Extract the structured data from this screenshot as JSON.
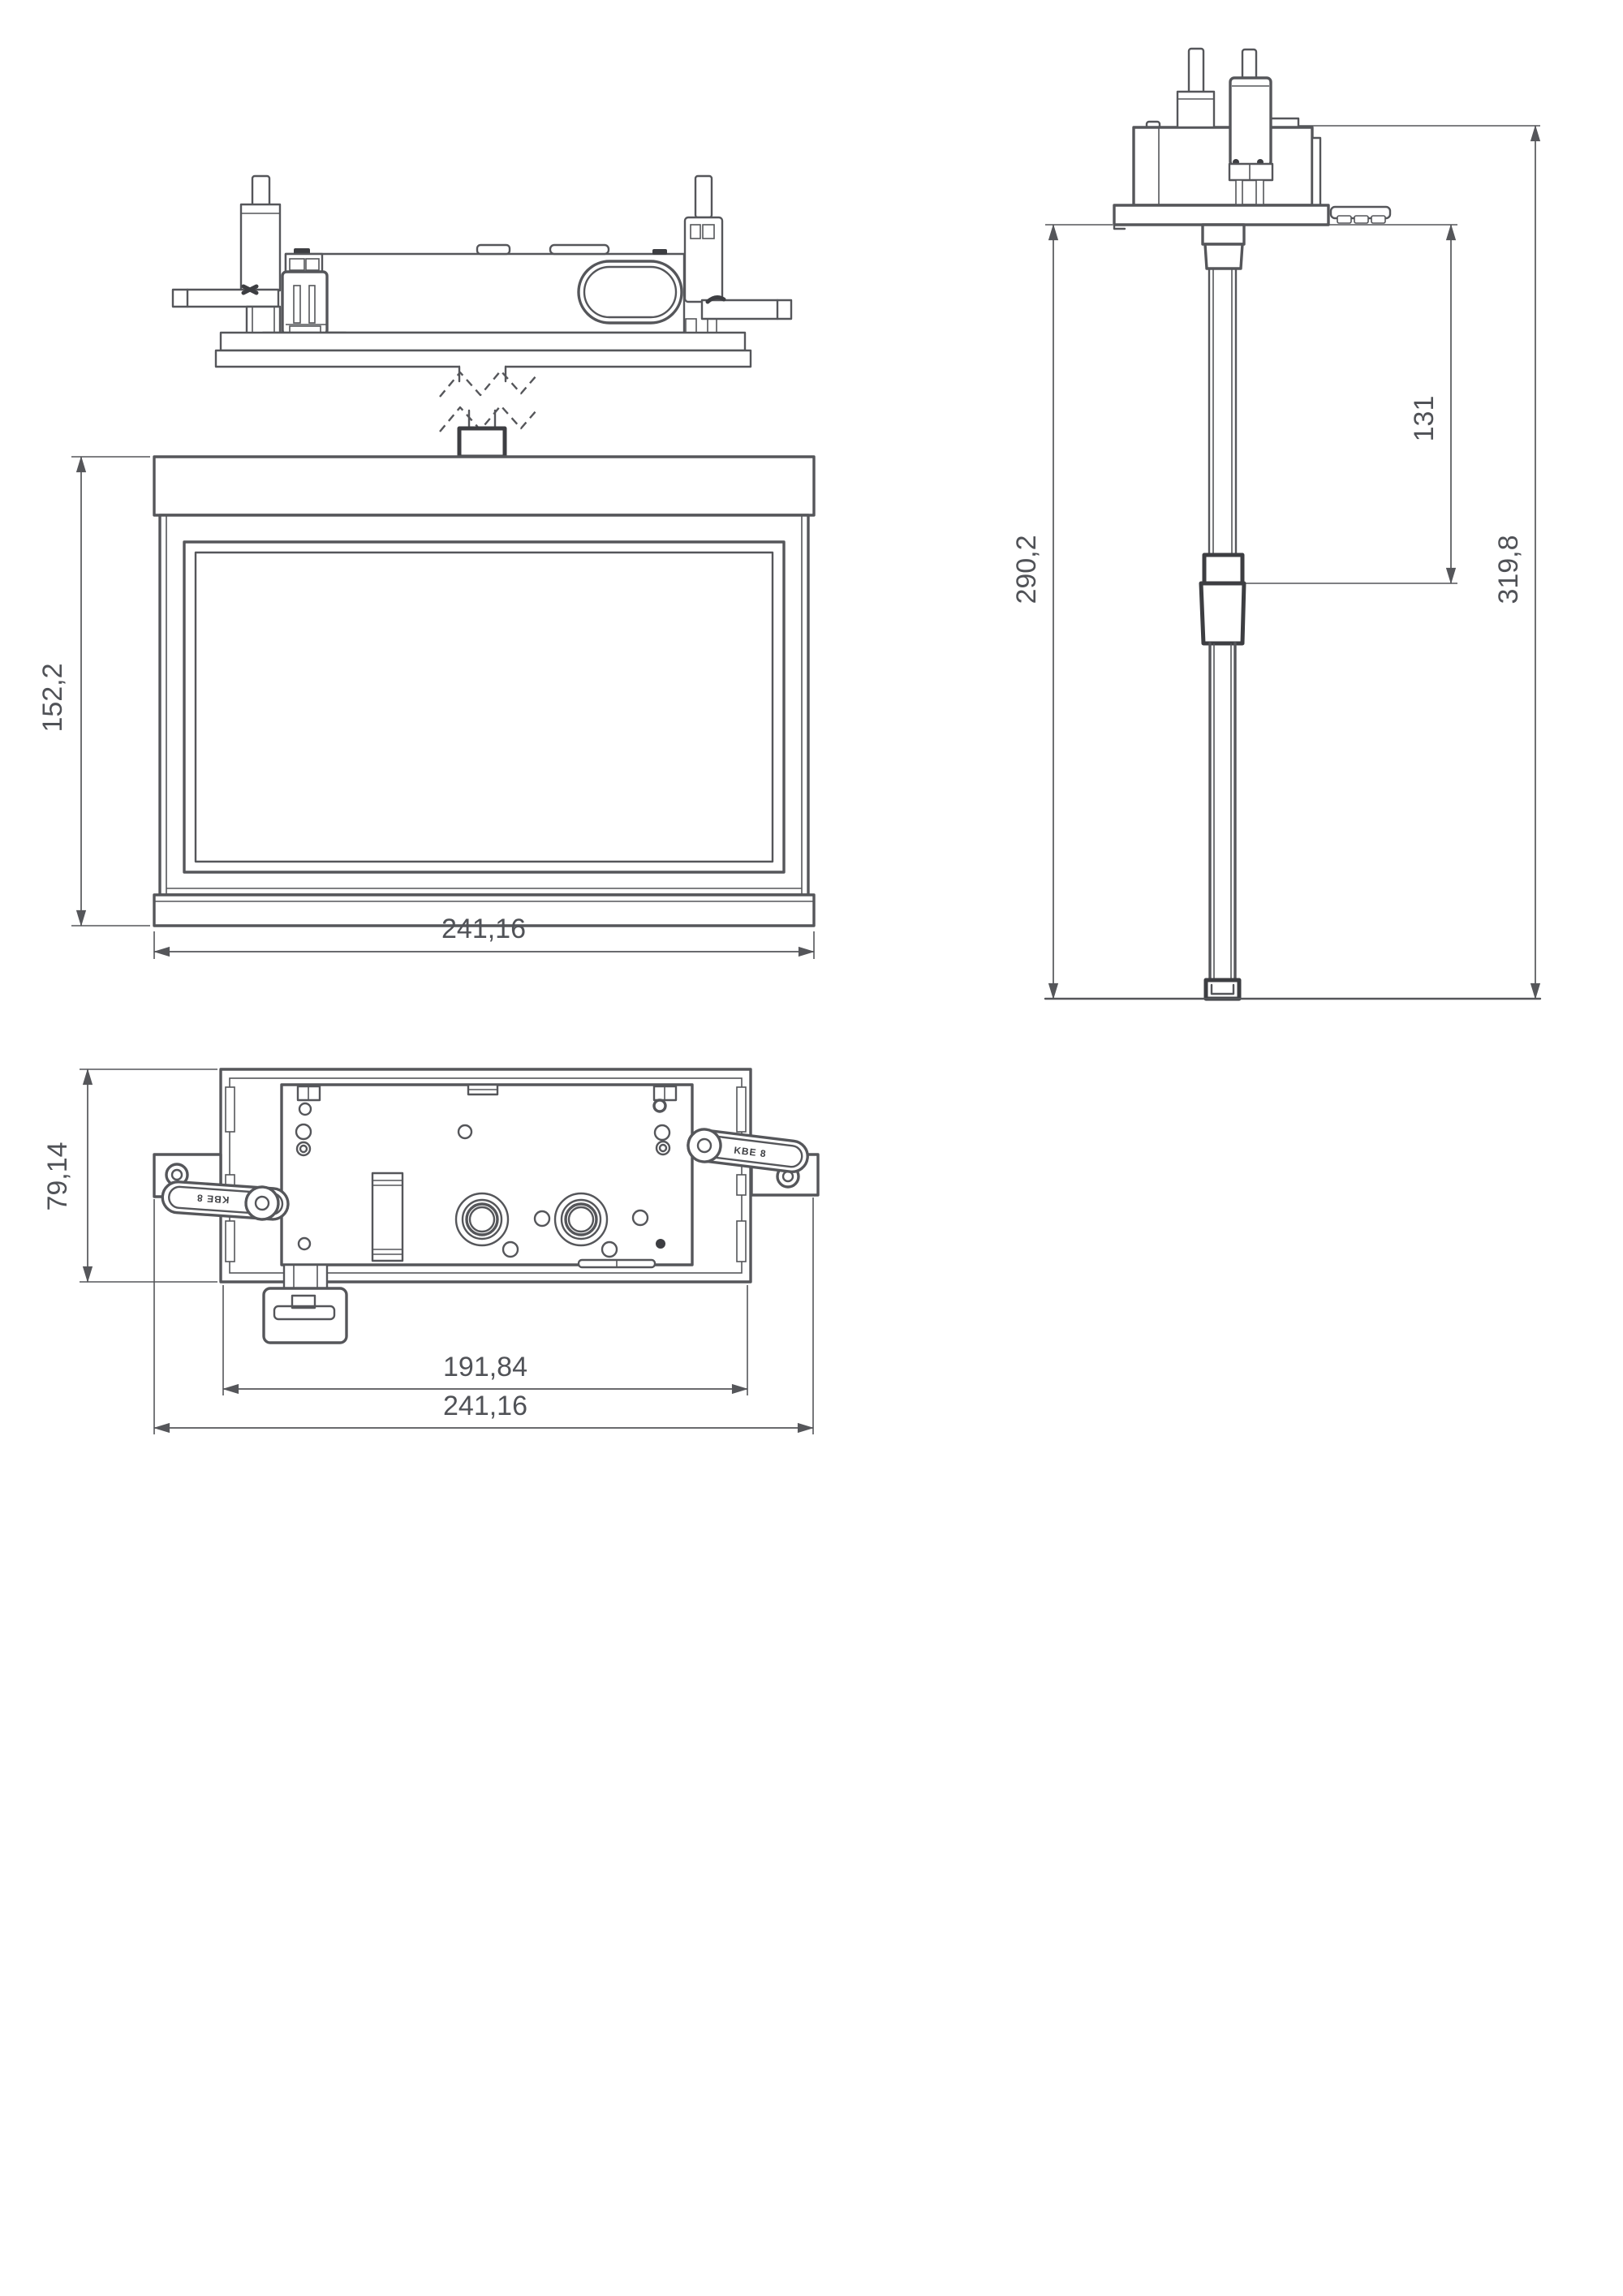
{
  "document": {
    "type": "technical-drawing",
    "subject": "recessed emergency luminaire - dimensioned views"
  },
  "colors": {
    "background": "#ffffff",
    "line": "#55565a",
    "line_dark": "#3d3e42",
    "text": "#505257"
  },
  "dimensions": {
    "front_height": "152,2",
    "front_width": "241,16",
    "side_recess_depth": "290,2",
    "side_upper_section": "131",
    "side_overall_height": "319,8",
    "plan_depth": "79,14",
    "plan_body_width": "191,84",
    "plan_overall_width": "241,16"
  },
  "labels": {
    "spring_left": "KBE 8",
    "spring_right": "KBE 8"
  }
}
